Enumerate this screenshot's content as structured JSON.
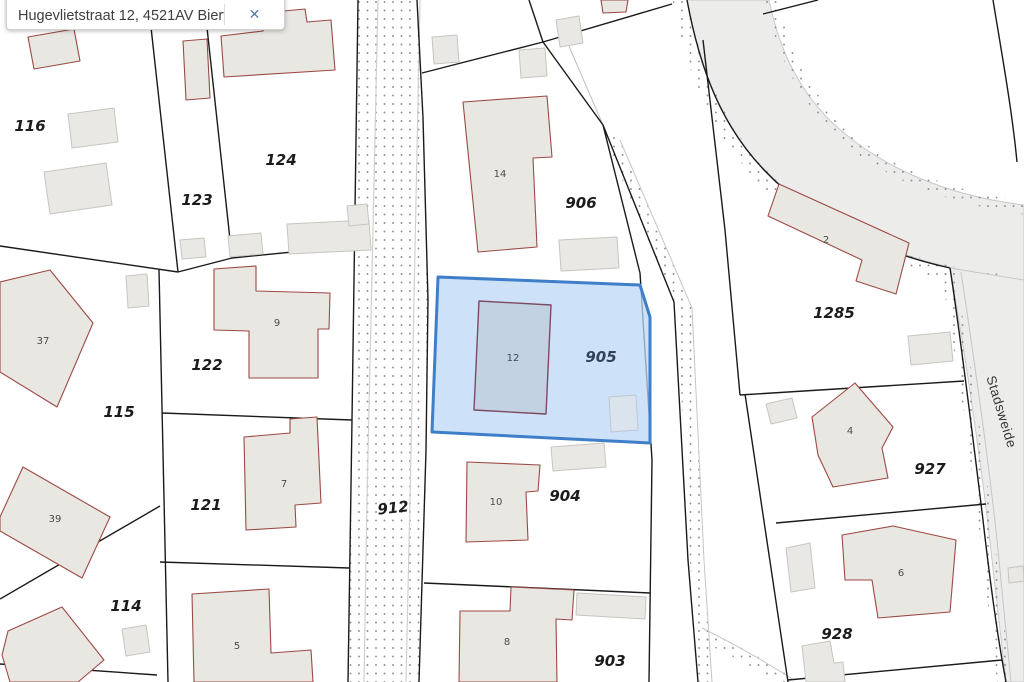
{
  "search_bar": {
    "query": "Hugevlietstraat 12, 4521AV Biervliet",
    "close_label": "✕"
  },
  "map": {
    "street_name": "Stadsweide",
    "selected": {
      "parcel": "905",
      "building": "12"
    },
    "parcel_labels": [
      "116",
      "123",
      "124",
      "122",
      "115",
      "121",
      "114",
      "912",
      "906",
      "905",
      "904",
      "903",
      "1285",
      "927",
      "928"
    ],
    "building_labels": [
      "14",
      "12",
      "10",
      "8",
      "9",
      "7",
      "5",
      "37",
      "39",
      "2",
      "4",
      "6"
    ],
    "colors": {
      "selected_parcel_fill": "#bcd7f5",
      "selected_parcel_border": "#3f7ec9",
      "selected_building_fill": "#c3d2e3",
      "building_fill": "#e8e7e2",
      "building_outline": "#9c4a44",
      "shed_fill": "#e9e8e4",
      "parcel_boundary": "#1a1a1a",
      "road_fill": "#ececeb",
      "stipple_dot": "#8f8f8f"
    }
  }
}
